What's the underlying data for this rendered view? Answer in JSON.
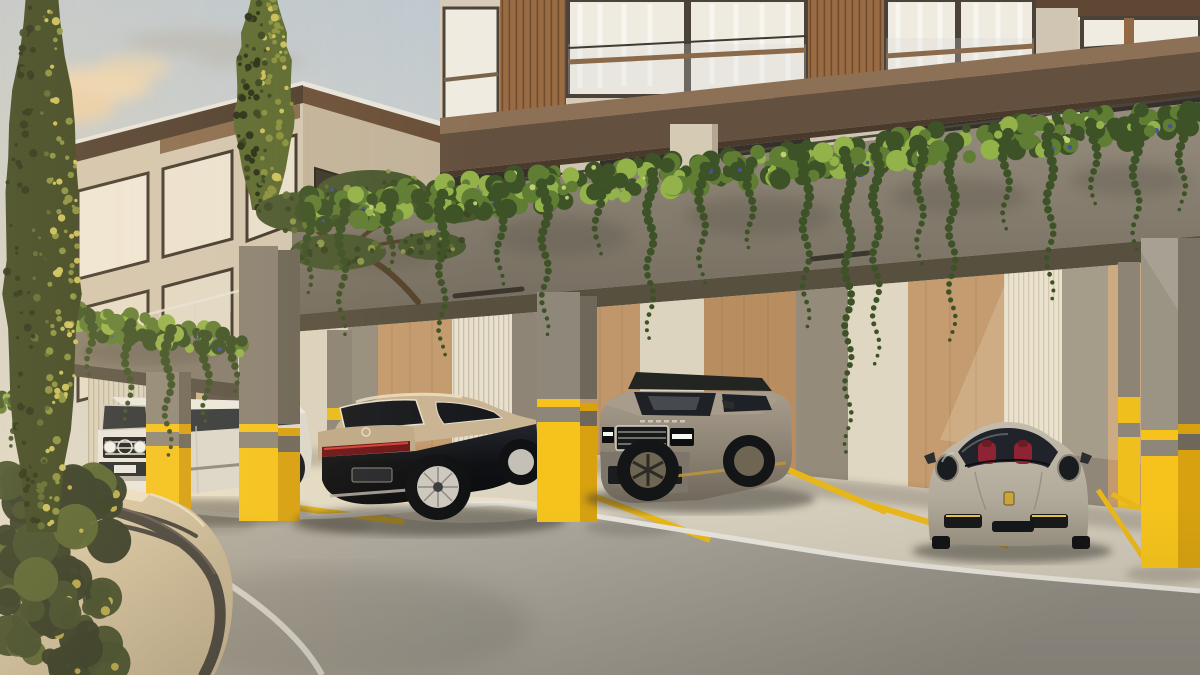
{
  "meta": {
    "type": "architectural-exterior-render",
    "subject": "Luxury residential building with covered parking bays, yellow columns, hanging greenery and four parked luxury cars",
    "width_px": 1200,
    "height_px": 675
  },
  "palette": {
    "sky_top": "#bfc9d1",
    "sky_mid": "#d8d6cc",
    "sky_horizon": "#e9dfc9",
    "cloud_warm": "#eed7b4",
    "cloud_gray": "#b3b0a9",
    "stone": "#d6cbb8",
    "stone_pier": "#cfc5b2",
    "wood_slat": "#9a6c44",
    "wood_slat_dark": "#6f4c2e",
    "slab_top": "#8c7157",
    "slab_brown": "#64503e",
    "soffit_brown": "#5f4733",
    "glass_warm": "#f0ebe0",
    "glass_dark": "#37332c",
    "frame_dark": "#4b433a",
    "fascia_top": "#968d7e",
    "fascia_bottom": "#746c5e",
    "ceiling_shadow": "#57503f",
    "column_gray": "#8f8779",
    "column_gray_side": "#6e675a",
    "column_yellow": "#f5c31c",
    "column_yellow_shade": "#d7a110",
    "column_stripe_gray": "#8e8678",
    "wall_cream": "#dbd2bd",
    "wall_cream2": "#e0d7c2",
    "wall_flute": "#e8e0cd",
    "wall_taupe": "#948b7b",
    "wall_taupe2": "#8e8576",
    "wall_wood": "#c49b6e",
    "wall_wood2": "#b88e61",
    "wood_grain": "#8a6b46",
    "bg_wall": "#d3c7b2",
    "bg_wall_shade": "#c2b49c",
    "bg_roof": "#4e3d2f",
    "bg_roof2": "#6a4f39",
    "roof_lip": "#e9e6df",
    "apron": "#d8d1bf",
    "apron_sun": "#ece3cb",
    "asphalt": "#a9a59b",
    "asphalt_dark": "#8f8b82",
    "line_white": "#e7e4db",
    "line_yellow": "#e9b61a",
    "retaining_wall_lit": "#e4d4b4",
    "retaining_wall": "#c9b897",
    "rail_dark": "#45423c",
    "cypress_dark": "#36421f",
    "cypress_mid": "#5a6930",
    "cypress_lit": "#8a923f",
    "cypress_glow": "#cdc45c",
    "plant_dark": "#3d5226",
    "plant_mid": "#5f7d33",
    "plant_light": "#93b24a",
    "plant_glow": "#c8d97a",
    "flower_blue": "#44549f",
    "car_white": "#e9e6df",
    "car_champagne": "#c9b493",
    "car_black": "#141518",
    "rr_body": "#8c8273",
    "rr_roof": "#232523",
    "porsche_body": "#b7afa0",
    "interior_red": "#8e2433",
    "chrome": "#cfccc2",
    "tire": "#16171a"
  },
  "scene": {
    "buildings": {
      "background_building": {
        "floors_visible": 2,
        "style": "flat roof, dark brown fascia, beige stucco, balconies"
      },
      "main_building": {
        "floors_visible": 2,
        "style": "cream stone, walnut slat strips, glass balustrades, brown floor slab band"
      }
    },
    "carport": {
      "front_columns": 4,
      "column_pattern": "gray upper, yellow base with one gray stripe",
      "back_wall": "alternating oak, cream plaster, fluted and taupe vertical panels",
      "parking_bays_visible": 4
    },
    "vehicles": [
      {
        "id": "suv-white",
        "label": "white boxy luxury SUV (G-Class style)",
        "color_key": "car_white"
      },
      {
        "id": "sedan-two-tone",
        "label": "two-tone champagne-over-black luxury sedan (Maybach style)",
        "color_key": "car_champagne"
      },
      {
        "id": "suv-gray",
        "label": "bronze-gray full-size luxury SUV (Range Rover style)",
        "color_key": "rr_body"
      },
      {
        "id": "coupe-beige",
        "label": "beige sports coupe with red interior (911 style)",
        "color_key": "porsche_body"
      }
    ],
    "road": {
      "surface": "asphalt driveway curving past raised concrete parking apron",
      "markings": {
        "white_edge_lines": 2,
        "yellow_bay_lines": 6
      },
      "guardrail": "dark gray curved handrail on beige retaining wall"
    },
    "vegetation": {
      "garlands": [
        {
          "host": "veg-garland-left",
          "seed": 11,
          "count": 110,
          "band": 26,
          "rmin": 4,
          "rmax": 9,
          "blue": 0.08,
          "path": [
            [
              50,
              314
            ],
            [
              120,
              322
            ],
            [
              200,
              334
            ],
            [
              242,
              342
            ]
          ],
          "strands": [
            [
              90,
              55
            ],
            [
              128,
              95
            ],
            [
              168,
              125
            ],
            [
              206,
              85
            ],
            [
              234,
              50
            ]
          ]
        },
        {
          "host": "veg-garland-main",
          "seed": 29,
          "count": 380,
          "band": 34,
          "rmin": 4,
          "rmax": 11,
          "blue": 0.12,
          "path": [
            [
              295,
              208
            ],
            [
              420,
              196
            ],
            [
              560,
              182
            ],
            [
              700,
              167
            ],
            [
              840,
              152
            ],
            [
              980,
              136
            ],
            [
              1100,
              122
            ],
            [
              1200,
              112
            ]
          ],
          "strands": [
            [
              308,
              85
            ],
            [
              342,
              130
            ],
            [
              390,
              70
            ],
            [
              442,
              160
            ],
            [
              500,
              95
            ],
            [
              545,
              150
            ],
            [
              598,
              75
            ],
            [
              650,
              165
            ],
            [
              702,
              115
            ],
            [
              750,
              85
            ],
            [
              806,
              170
            ],
            [
              848,
              300
            ],
            [
              876,
              215
            ],
            [
              920,
              120
            ],
            [
              952,
              200
            ],
            [
              1006,
              95
            ],
            [
              1050,
              170
            ],
            [
              1094,
              80
            ],
            [
              1136,
              130
            ],
            [
              1182,
              95
            ]
          ]
        },
        {
          "host": "veg-garland-edge",
          "seed": 47,
          "count": 40,
          "band": 20,
          "rmin": 3,
          "rmax": 7,
          "blue": 0.1,
          "path": [
            [
              0,
              398
            ],
            [
              26,
              402
            ],
            [
              52,
              408
            ]
          ],
          "strands": [
            [
              14,
              45
            ],
            [
              38,
              62
            ]
          ]
        }
      ],
      "cypresses": [
        {
          "host": "veg-cypress-1",
          "seed": 5,
          "cx": 42,
          "w": 76,
          "top": -12,
          "bottom": 532,
          "count": 230
        },
        {
          "host": "veg-cypress-2",
          "seed": 7,
          "cx": 264,
          "w": 58,
          "top": -8,
          "bottom": 210,
          "count": 130,
          "sunny": true
        }
      ],
      "canopies": {
        "host": "veg-bonsai",
        "seed": 13,
        "speckles": 24,
        "blobs": [
          {
            "cx": 302,
            "cy": 212,
            "rx": 46,
            "ry": 20
          },
          {
            "cx": 372,
            "cy": 192,
            "rx": 56,
            "ry": 22
          },
          {
            "cx": 452,
            "cy": 206,
            "rx": 40,
            "ry": 17
          },
          {
            "cx": 338,
            "cy": 252,
            "rx": 48,
            "ry": 18
          },
          {
            "cx": 432,
            "cy": 246,
            "rx": 34,
            "ry": 14
          }
        ]
      },
      "bushes": [
        {
          "host": "veg-bush-left",
          "seed": 23,
          "x0": 0,
          "x1": 110,
          "y0": 475,
          "y1": 675,
          "count": 85
        }
      ]
    }
  }
}
